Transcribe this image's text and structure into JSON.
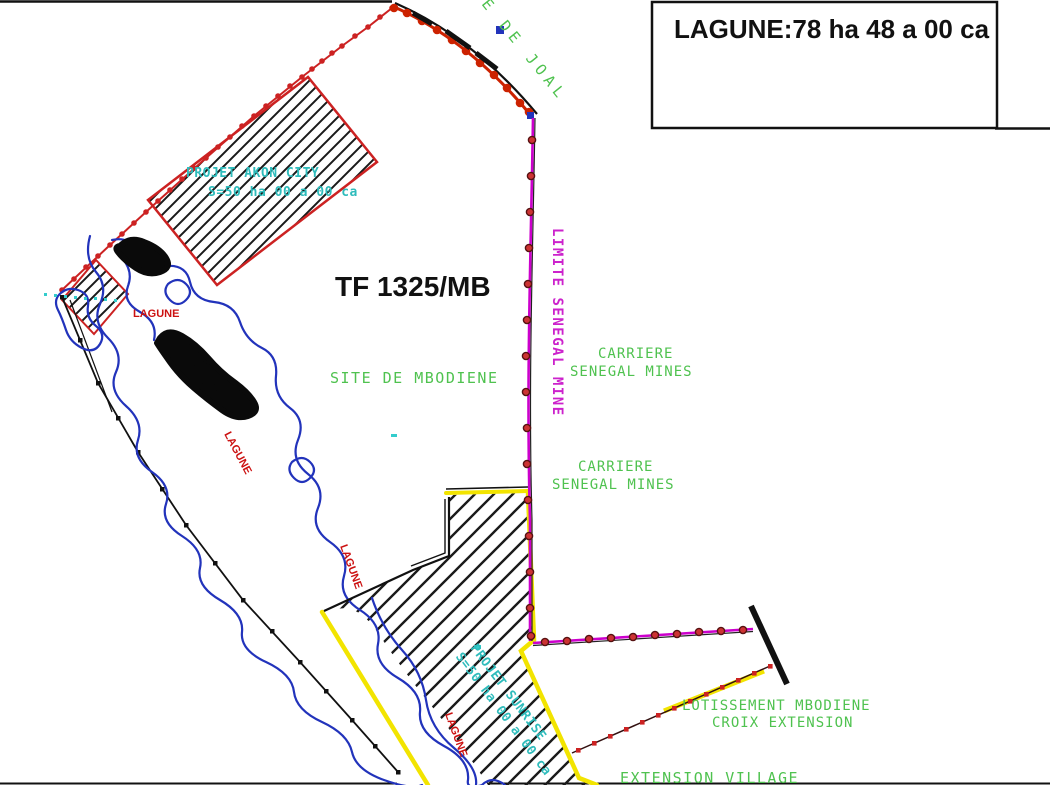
{
  "title_box": {
    "label": "LAGUNE:78 ha 48 a 00 ca"
  },
  "parcel": {
    "id": "TF 1325/MB",
    "site": "SITE DE MBODIENE"
  },
  "road": {
    "label": "E DE JOAL"
  },
  "mine_limit": {
    "label": "LIMITE SENEGAL MINE"
  },
  "carriere_upper": {
    "line1": "CARRIERE",
    "line2": "SENEGAL MINES"
  },
  "carriere_lower": {
    "line1": "CARRIERE",
    "line2": "SENEGAL MINES"
  },
  "akon_city": {
    "line1": "PROJET AKON CITY",
    "line2": "S=50 ha 00 a 00 ca"
  },
  "sunrise": {
    "line1": "PROJET SUNRISE",
    "line2": "S=50 ha 00 a 00 ca"
  },
  "lotissement": {
    "line1": "LOTISSEMENT MBODIENE",
    "line2": "CROIX EXTENSION"
  },
  "extension_village": {
    "label": "EXTENSION VILLAGE"
  },
  "lagune_labels": [
    "LAGUNE",
    "LAGUNE",
    "LAGUNE",
    "LAGUNE"
  ],
  "colors": {
    "green_text": "#4fc24f",
    "cyan_text": "#2fbcbc",
    "magenta_line": "#cc00cc",
    "red_line": "#cc2222",
    "red_label": "#cc1111",
    "yellow_boundary": "#f2e400",
    "blue_water": "#2233bb",
    "black_ink": "#111111"
  }
}
